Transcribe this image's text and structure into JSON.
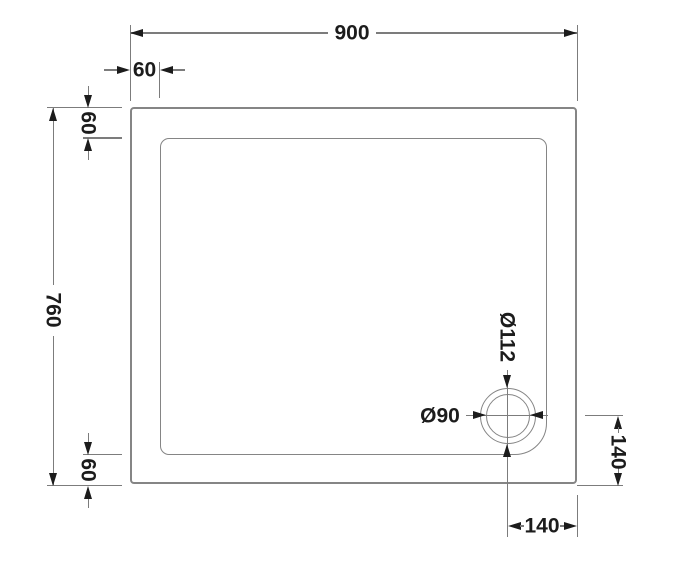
{
  "drawing": {
    "labels": {
      "overall_width": "900",
      "overall_height": "760",
      "rim_top": "60",
      "rim_left_top": "60",
      "rim_left_bottom": "60",
      "waste_outer_diameter": "Ø112",
      "waste_inner_diameter": "Ø90",
      "waste_offset_right": "140",
      "waste_offset_bottom": "140"
    },
    "colors": {
      "background": "#ffffff",
      "dimension_line": "#7c7c7c",
      "tray_outline": "#858585",
      "text_and_arrows": "#1c1c1c"
    }
  }
}
